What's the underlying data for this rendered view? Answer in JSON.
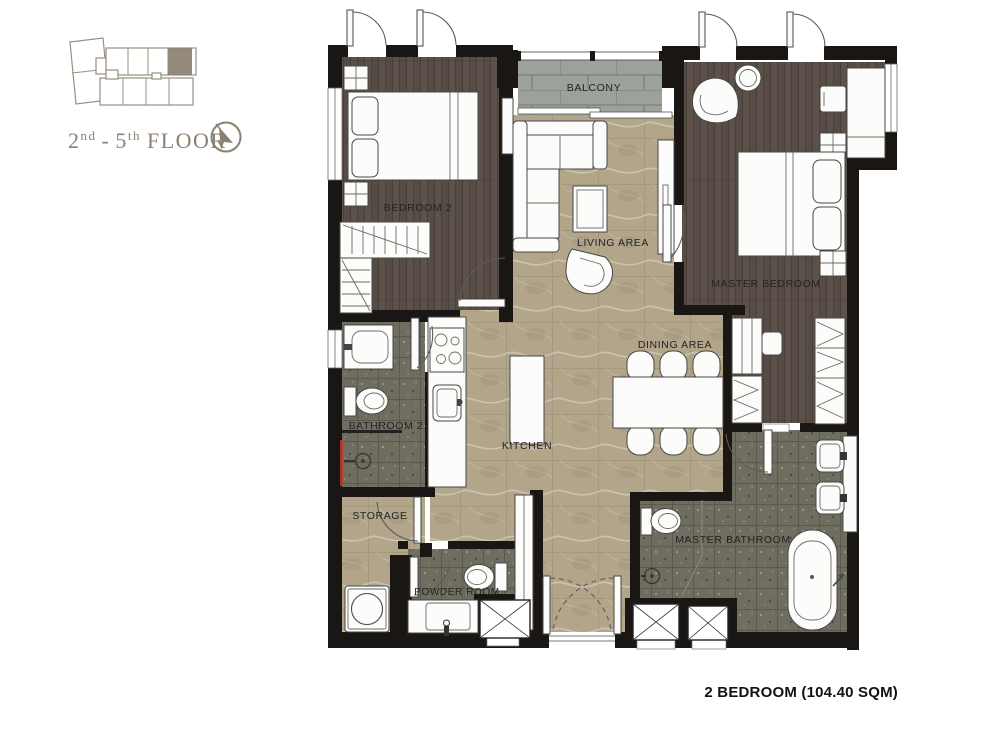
{
  "key_plan": {
    "floor_label": {
      "start_num": "2",
      "start_sup": "nd",
      "dash": "-",
      "end_num": "5",
      "end_sup": "th",
      "word": "FLOOR"
    }
  },
  "rooms": {
    "bedroom2": "BEDROOM 2",
    "balcony": "BALCONY",
    "living": "LIVING AREA",
    "master_bedroom": "MASTER BEDROOM",
    "dining": "DINING AREA",
    "kitchen": "KITCHEN",
    "bathroom2": "BATHROOM 2",
    "storage": "STORAGE",
    "powder": "POWDER ROOM",
    "master_bathroom": "MASTER BATHROOM"
  },
  "caption": "2 BEDROOM (104.40 SQM)",
  "colors": {
    "accent": "#8b8070",
    "wall": "#1a1613",
    "wood": "#5c524a",
    "marble": "#b2a58a",
    "mosaic": "#6e6d5f",
    "balcony": "#9ca29a",
    "paper": "#ffffff"
  }
}
